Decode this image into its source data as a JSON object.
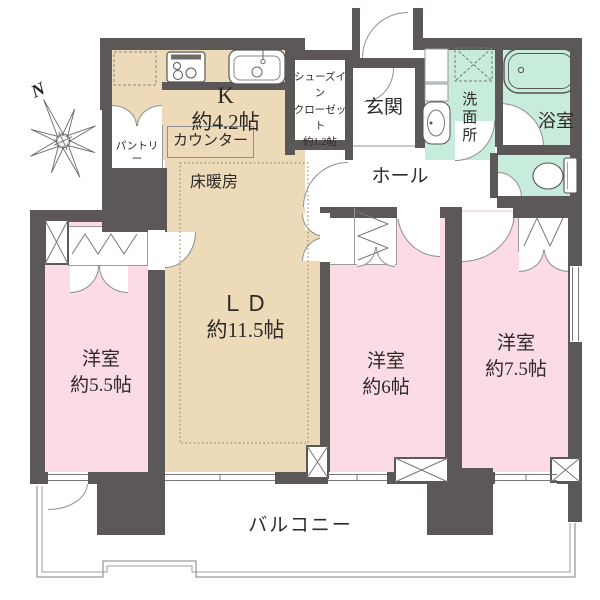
{
  "palette": {
    "wall": "#5c5858",
    "living_dining_floor": "#ecdab9",
    "bedroom_floor": "#fbdce4",
    "wet_area_floor": "#c8ecdb",
    "outline": "#9b9b9b",
    "text": "#2e2a28"
  },
  "compass": {
    "north_label": "N"
  },
  "rooms": {
    "kitchen": {
      "name": "K",
      "size": "約4.2帖"
    },
    "counter": {
      "label": "カウンター"
    },
    "floor_heating": {
      "label": "床暖房"
    },
    "pantry": {
      "label": "パントリー"
    },
    "shoes_in_closet": {
      "line1": "シューズイン",
      "line2": "クローゼット",
      "line3": "約1.2帖"
    },
    "entrance": {
      "label": "玄関"
    },
    "hall": {
      "label": "ホール"
    },
    "washroom": {
      "label": "洗面所"
    },
    "bathroom": {
      "label": "浴室"
    },
    "living_dining": {
      "name": "ＬＤ",
      "size": "約11.5帖"
    },
    "bedroom_55": {
      "name": "洋室",
      "size": "約5.5帖"
    },
    "bedroom_6": {
      "name": "洋室",
      "size": "約6帖"
    },
    "bedroom_75": {
      "name": "洋室",
      "size": "約7.5帖"
    },
    "balcony": {
      "label": "バルコニー"
    }
  }
}
